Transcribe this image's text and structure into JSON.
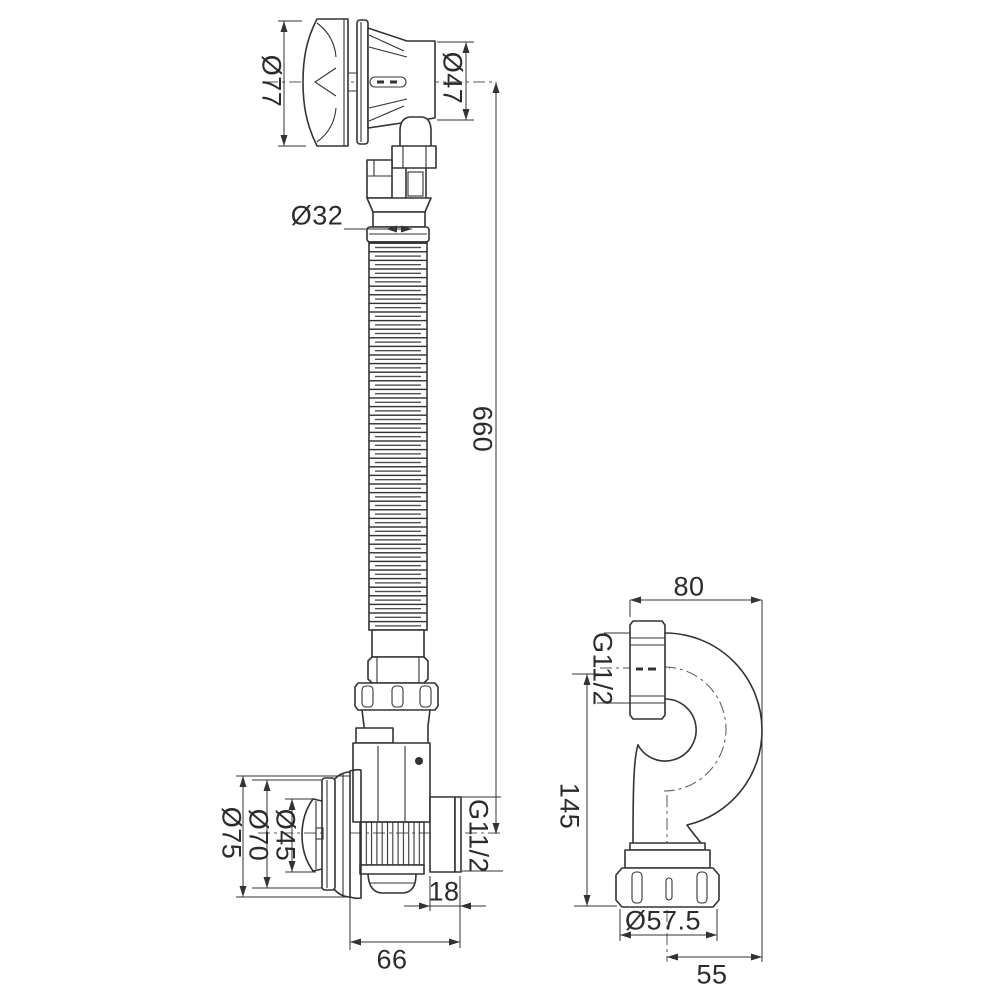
{
  "style": {
    "background": "#ffffff",
    "line_color": "#333333"
  },
  "views": {
    "main_assembly": {
      "labels": {
        "overflow_cap_diameter": "Ø77",
        "overflow_body_diameter": "Ø47",
        "hose_diameter": "Ø32",
        "hose_length": "660",
        "outlet_thread": "G11/2",
        "outlet_length": "18",
        "body_width": "66",
        "seal_diameter": "Ø75",
        "flange_diameter": "Ø70",
        "plug_diameter": "Ø45"
      }
    },
    "s_trap": {
      "labels": {
        "width": "80",
        "inlet_thread": "G11/2",
        "height": "145",
        "nut_diameter": "Ø57.5",
        "outlet_offset": "55"
      }
    }
  }
}
